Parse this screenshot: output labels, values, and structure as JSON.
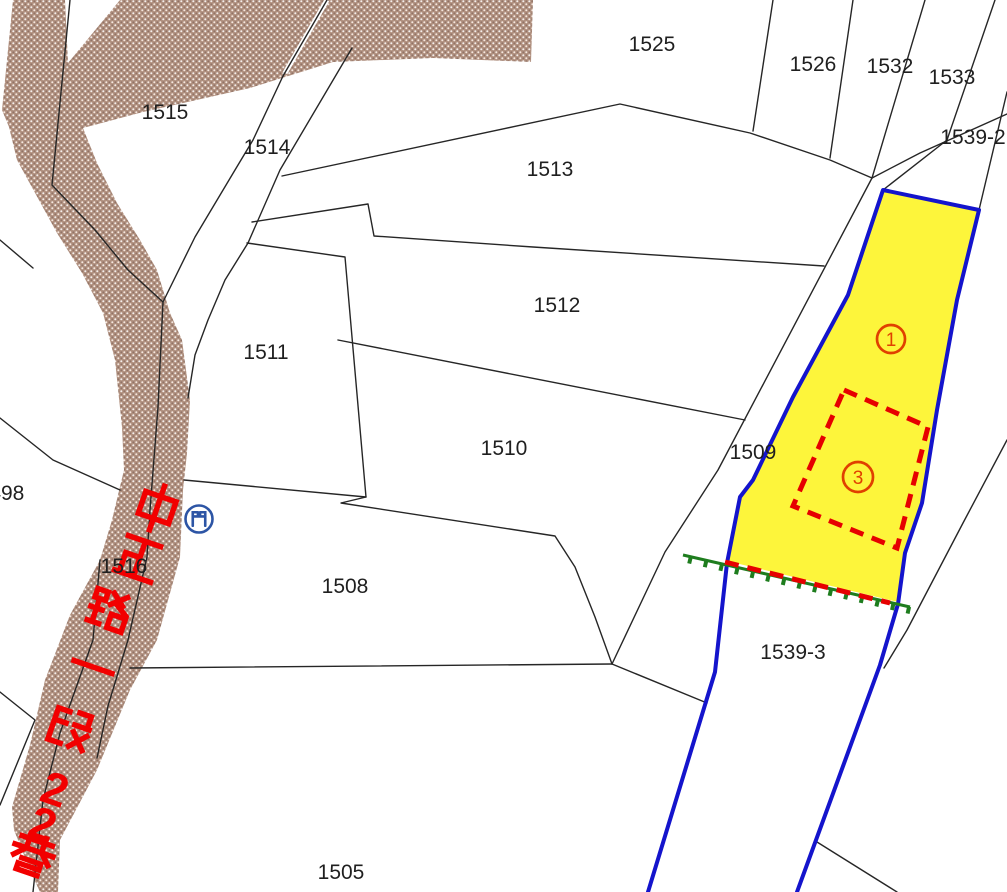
{
  "map_type": "cadastral-parcel-map",
  "colors": {
    "background": "#ffffff",
    "parcel_line": "#262626",
    "label_text": "#1f1f1f",
    "road_fill": "#b0907f",
    "road_name_text": "#f20000",
    "highlight_outline": "#1414cc",
    "highlight_fill": "#fdf53b",
    "annotation_red": "#e60000",
    "circled_number_red": "#e04000",
    "fence_green": "#1e7d1e",
    "gate_blue": "#2d55a5"
  },
  "road": {
    "name": "中正路一段22巷",
    "chars": [
      "中",
      "正",
      "路",
      "一",
      "段",
      "2",
      "2",
      "巷"
    ]
  },
  "gate": {
    "char": "門"
  },
  "parcels": {
    "labels": [
      {
        "text": "1525"
      },
      {
        "text": "1526"
      },
      {
        "text": "1532"
      },
      {
        "text": "1533"
      },
      {
        "text": "1539-2"
      },
      {
        "text": "1515"
      },
      {
        "text": "1514"
      },
      {
        "text": "1513"
      },
      {
        "text": "1512"
      },
      {
        "text": "1511"
      },
      {
        "text": "1510"
      },
      {
        "text": "1509"
      },
      {
        "text": "1508"
      },
      {
        "text": "1516"
      },
      {
        "text": "1498"
      },
      {
        "text": "1505"
      },
      {
        "text": "1539-3"
      }
    ]
  },
  "annotations": {
    "circled_numbers": [
      {
        "value": "1"
      },
      {
        "value": "3"
      }
    ],
    "fence": {
      "x1": 683,
      "y1": 555,
      "x2": 910,
      "y2": 607,
      "tick_spacing": 16,
      "tick_length": 7
    }
  }
}
